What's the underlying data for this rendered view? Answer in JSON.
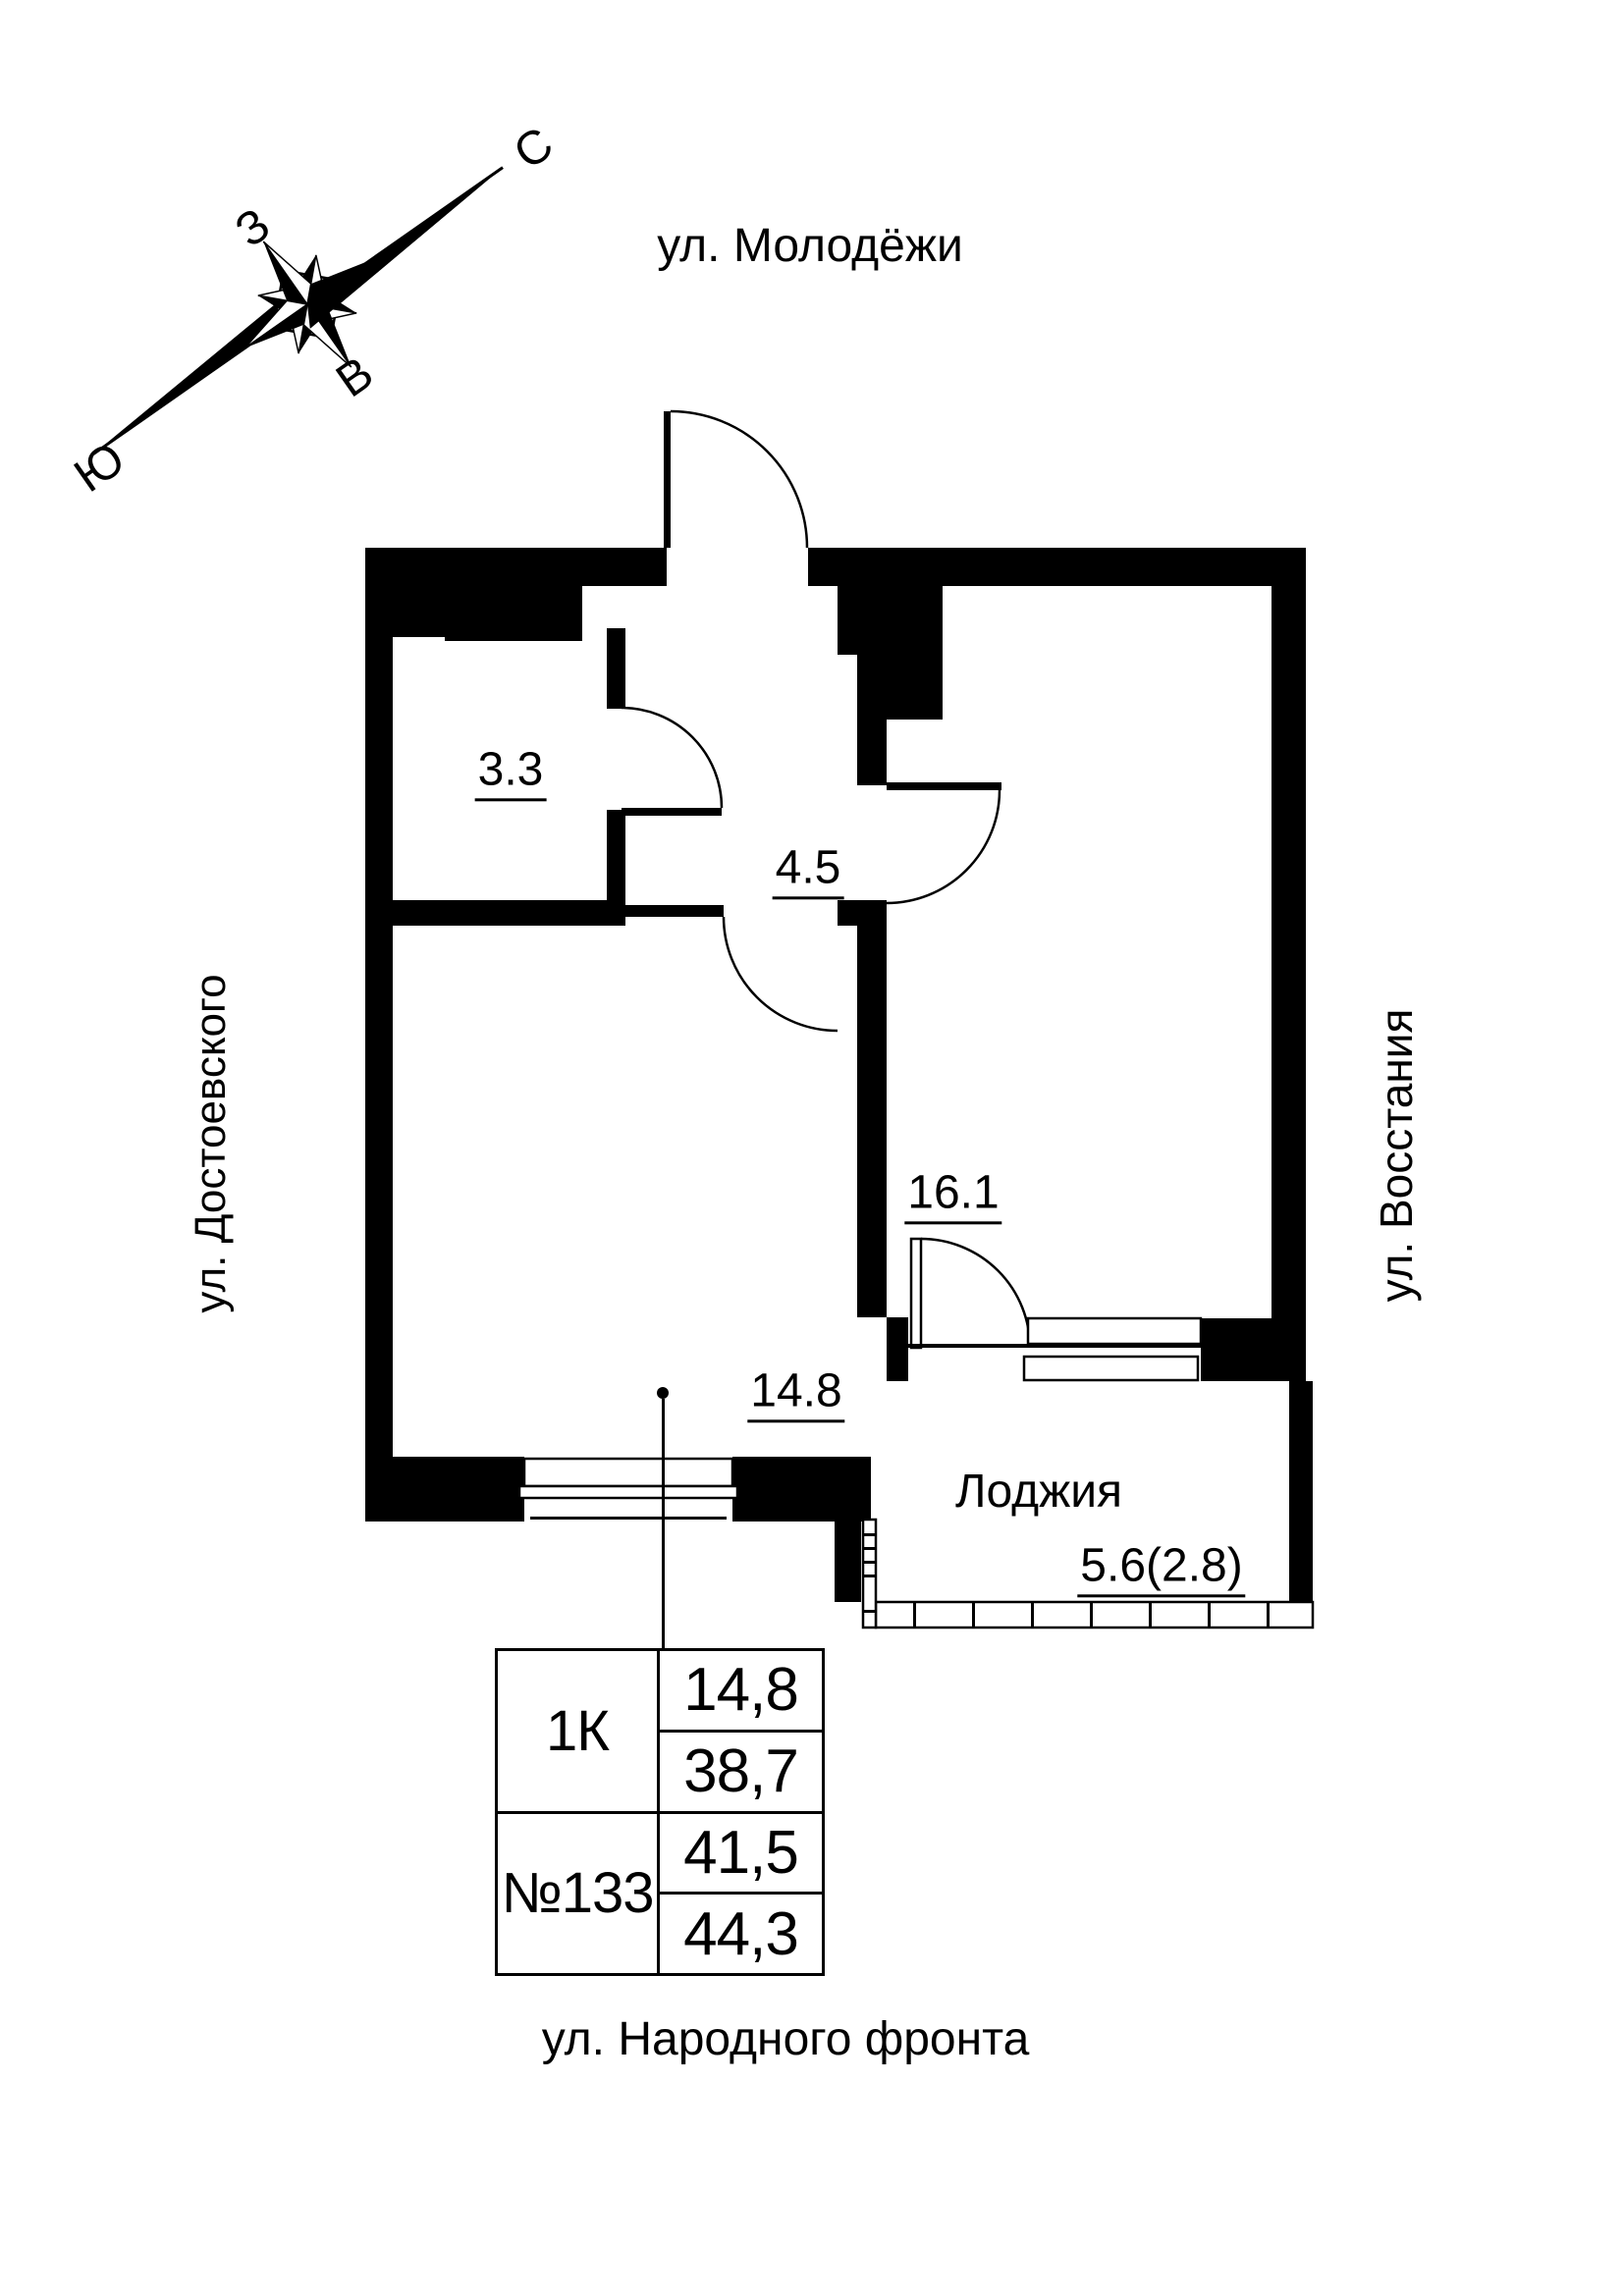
{
  "page": {
    "background": "#ffffff",
    "ink": "#000000"
  },
  "compass": {
    "north": "С",
    "south": "Ю",
    "west": "З",
    "east": "В"
  },
  "streets": {
    "top": "ул. Молодёжи",
    "left": "ул. Достоевского",
    "right": "ул. Восстания",
    "bottom": "ул. Народного фронта"
  },
  "plan": {
    "rooms": {
      "r33": {
        "label": "3.3"
      },
      "r45": {
        "label": "4.5"
      },
      "r161": {
        "label": "16.1"
      },
      "r148": {
        "label": "14.8"
      },
      "loggia": {
        "name": "Лоджия",
        "label": "5.6(2.8)"
      }
    }
  },
  "info_table": {
    "rooms_count": "1К",
    "apartment_number": "№133",
    "living_area": "14,8",
    "area_without_loggia": "38,7",
    "area_reduced": "41,5",
    "area_total": "44,3"
  }
}
